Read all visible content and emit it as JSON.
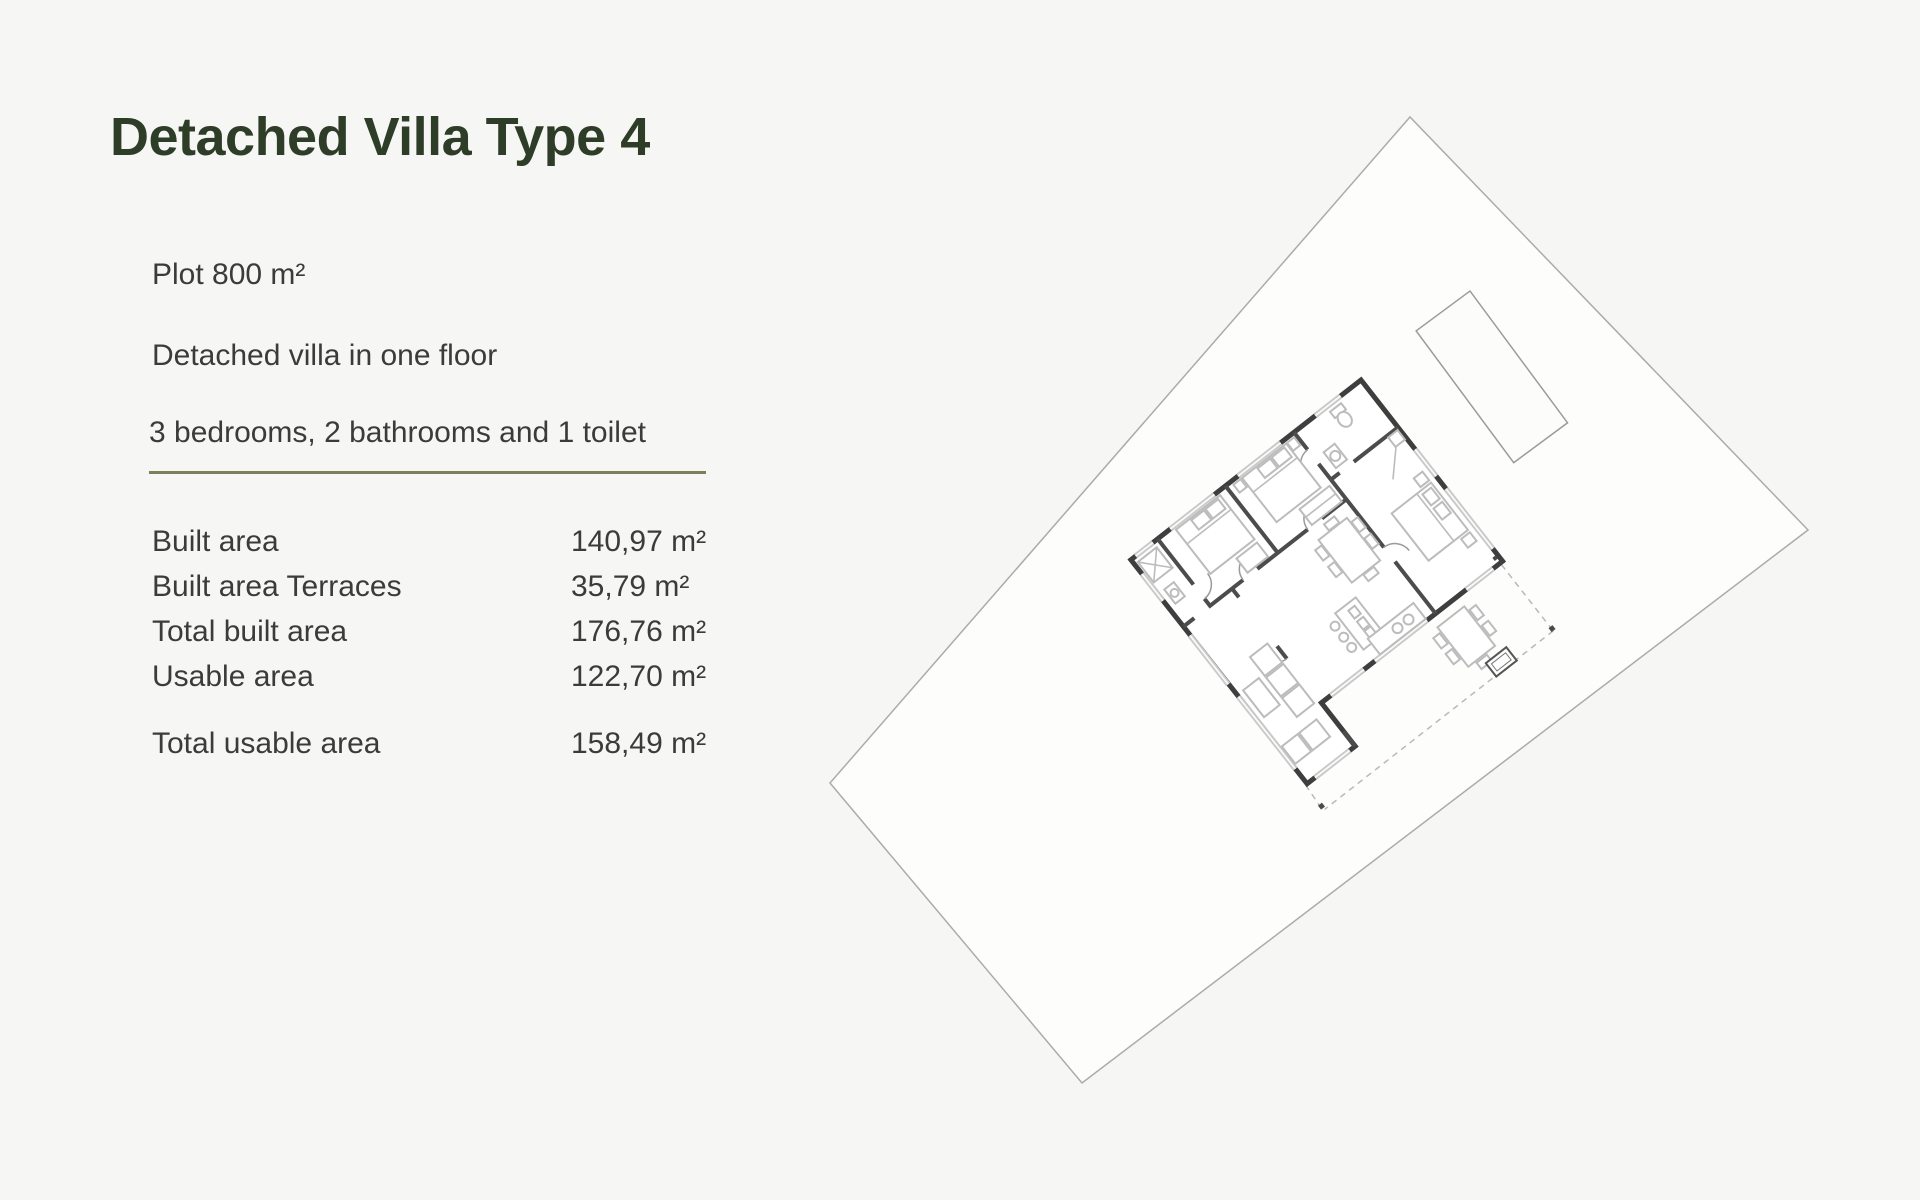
{
  "page": {
    "background_color": "#f6f6f4",
    "text_color": "#3b3b39",
    "title_color": "#2e3d27",
    "divider_color": "#7c7f58"
  },
  "header": {
    "title": "Detached Villa Type 4"
  },
  "description": {
    "plot": "Plot 800 m²",
    "floors": "Detached villa in one floor",
    "rooms": "3 bedrooms, 2 bathrooms and 1 toilet"
  },
  "areas": {
    "rows": [
      {
        "label": "Built area",
        "value": "140,97 m²"
      },
      {
        "label": "Built area Terraces",
        "value": "35,79 m²"
      },
      {
        "label": "Total built area",
        "value": "176,76 m²"
      },
      {
        "label": "Usable area",
        "value": "122,70 m²"
      }
    ],
    "total": {
      "label": "Total usable area",
      "value": "158,49 m²"
    }
  },
  "floorplan": {
    "name": "villa-type-4-site-plan",
    "elements": [
      "plot-boundary",
      "pool",
      "villa-floor-plan",
      "open-terrace-dashed",
      "corner-markers"
    ]
  }
}
